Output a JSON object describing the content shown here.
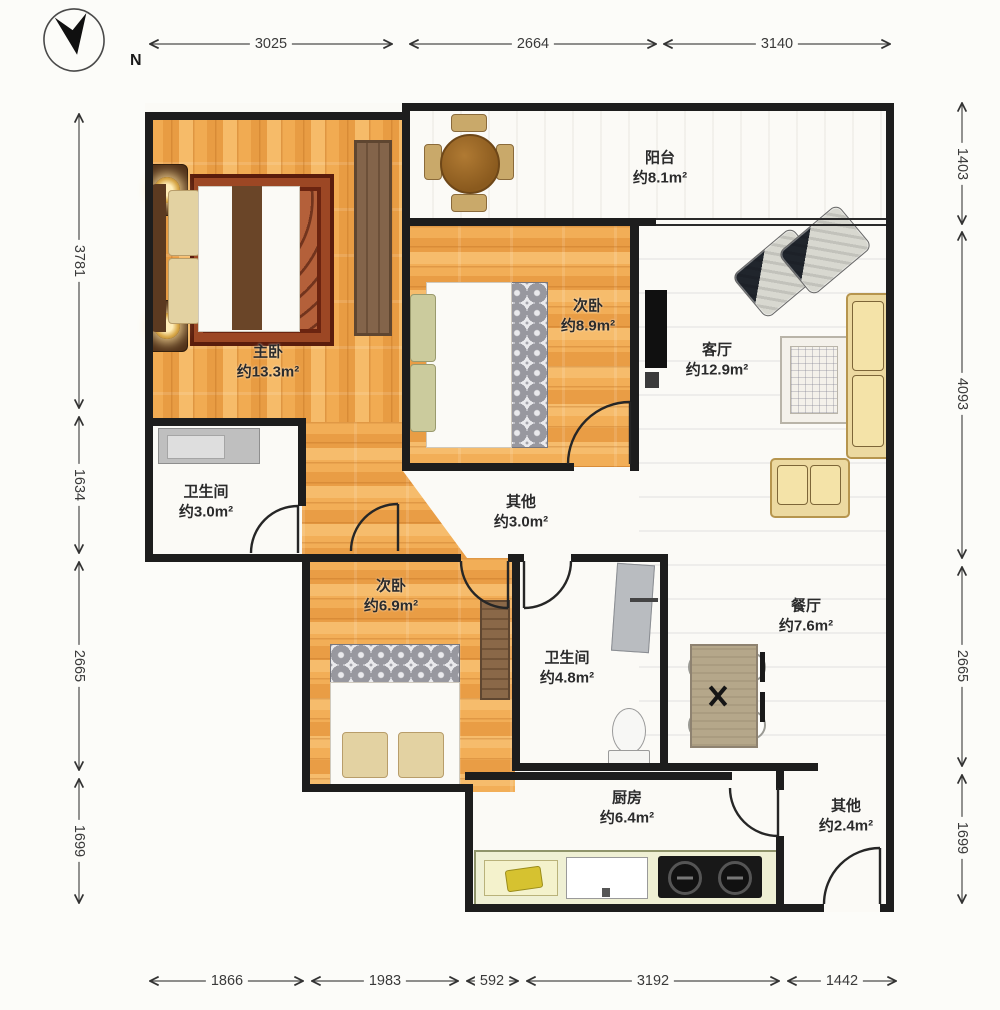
{
  "compass": {
    "label": "N"
  },
  "dimensions": {
    "top": [
      "3025",
      "2664",
      "3140"
    ],
    "left": [
      "3781",
      "1634",
      "2665",
      "1699"
    ],
    "right": [
      "1403",
      "4093",
      "2665",
      "1699"
    ],
    "bottom": [
      "1866",
      "1983",
      "592",
      "3192",
      "1442"
    ]
  },
  "rooms": [
    {
      "name": "阳台",
      "area": "约8.1m²"
    },
    {
      "name": "主卧",
      "area": "约13.3m²"
    },
    {
      "name": "次卧",
      "area": "约8.9m²"
    },
    {
      "name": "客厅",
      "area": "约12.9m²"
    },
    {
      "name": "卫生间",
      "area": "约3.0m²"
    },
    {
      "name": "其他",
      "area": "约3.0m²"
    },
    {
      "name": "次卧",
      "area": "约6.9m²"
    },
    {
      "name": "卫生间",
      "area": "约4.8m²"
    },
    {
      "name": "餐厅",
      "area": "约7.6m²"
    },
    {
      "name": "厨房",
      "area": "约6.4m²"
    },
    {
      "name": "其他",
      "area": "约2.4m²"
    }
  ],
  "colors": {
    "wall": "#1d1d1d",
    "wood_floor": "#efa64c",
    "rug": "#8a3a1f",
    "sofa": "#ecd9a0",
    "kitchen_counter": "#eff0d4",
    "stove": "#181818"
  }
}
